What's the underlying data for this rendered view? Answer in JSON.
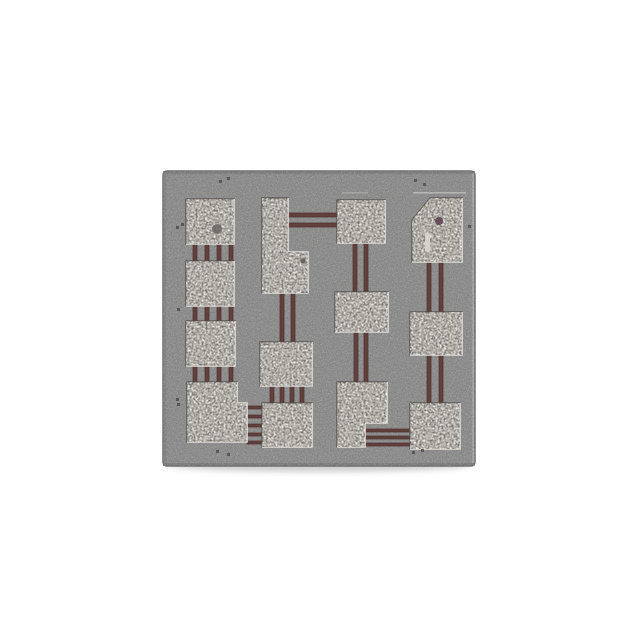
{
  "scene": {
    "type": "product-photo",
    "subject": "integrated-circuit chip macro photograph",
    "background_color": "#ffffff",
    "visible_text": ""
  },
  "chip": {
    "frame": {
      "x": 163,
      "y": 171,
      "width": 312,
      "height": 295,
      "corner_radius": 4
    },
    "colors": {
      "body": "#8b8b8b",
      "body_edge": "#6f6f6f",
      "pad_base": "#b7b4b0",
      "pad_edge_dark": "#504c48",
      "pad_edge_light": "#f5f3ee",
      "trace_fill": "#64403c",
      "trace_outline": "#47302e",
      "shadow": "#c2c2c2",
      "fiducial": "#4f4f4f"
    },
    "pad_count": 13,
    "pads": [
      {
        "name": "pad-col1-top",
        "shape": "rect",
        "x": 186,
        "y": 199,
        "w": 48,
        "h": 45
      },
      {
        "name": "pad-col1-second",
        "shape": "rect",
        "x": 186,
        "y": 261,
        "w": 48,
        "h": 45
      },
      {
        "name": "pad-col1-third",
        "shape": "rect",
        "x": 186,
        "y": 321,
        "w": 49,
        "h": 45
      },
      {
        "name": "pad-col1-bottom-L",
        "shape": "polygon",
        "points": [
          [
            187,
            382
          ],
          [
            237,
            382
          ],
          [
            237,
            403
          ],
          [
            247,
            403
          ],
          [
            247,
            442
          ],
          [
            187,
            442
          ]
        ],
        "shine": [
          [
            237,
            382
          ],
          [
            237,
            403
          ],
          [
            247,
            403
          ],
          [
            247,
            442
          ],
          [
            187,
            442
          ]
        ]
      },
      {
        "name": "pad-col2-top-L",
        "shape": "polygon",
        "points": [
          [
            262,
            198
          ],
          [
            288,
            198
          ],
          [
            288,
            252
          ],
          [
            308,
            252
          ],
          [
            308,
            293
          ],
          [
            262,
            293
          ]
        ],
        "shine": [
          [
            288,
            198
          ],
          [
            288,
            252
          ],
          [
            308,
            252
          ],
          [
            308,
            293
          ],
          [
            262,
            293
          ]
        ]
      },
      {
        "name": "pad-col2-middle",
        "shape": "rect",
        "x": 260,
        "y": 342,
        "w": 52,
        "h": 44
      },
      {
        "name": "pad-col2-bottom",
        "shape": "rect",
        "x": 262,
        "y": 403,
        "w": 50,
        "h": 44
      },
      {
        "name": "pad-col3-top",
        "shape": "rect",
        "x": 337,
        "y": 200,
        "w": 48,
        "h": 43
      },
      {
        "name": "pad-col3-middle",
        "shape": "rect",
        "x": 335,
        "y": 292,
        "w": 53,
        "h": 40
      },
      {
        "name": "pad-col3-bottom-L",
        "shape": "polygon",
        "points": [
          [
            337,
            382
          ],
          [
            387,
            382
          ],
          [
            387,
            423
          ],
          [
            365,
            423
          ],
          [
            365,
            447
          ],
          [
            337,
            447
          ]
        ],
        "shine": [
          [
            387,
            382
          ],
          [
            387,
            423
          ],
          [
            365,
            423
          ],
          [
            365,
            447
          ],
          [
            337,
            447
          ]
        ]
      },
      {
        "name": "pad-col4-top-pentagon",
        "shape": "polygon",
        "points": [
          [
            430,
            198
          ],
          [
            462,
            198
          ],
          [
            462,
            262
          ],
          [
            412,
            262
          ],
          [
            412,
            220
          ]
        ],
        "shine": [
          [
            462,
            198
          ],
          [
            462,
            262
          ],
          [
            412,
            262
          ]
        ]
      },
      {
        "name": "pad-col4-middle",
        "shape": "rect",
        "x": 410,
        "y": 312,
        "w": 52,
        "h": 43
      },
      {
        "name": "pad-col4-bottom",
        "shape": "rect",
        "x": 410,
        "y": 403,
        "w": 50,
        "h": 46
      }
    ],
    "traces": [
      {
        "x": 193,
        "y": 244,
        "w": 4,
        "h": 18
      },
      {
        "x": 205,
        "y": 244,
        "w": 4,
        "h": 18
      },
      {
        "x": 217,
        "y": 244,
        "w": 4,
        "h": 18
      },
      {
        "x": 229,
        "y": 244,
        "w": 4,
        "h": 18
      },
      {
        "x": 193,
        "y": 306,
        "w": 4,
        "h": 16
      },
      {
        "x": 205,
        "y": 306,
        "w": 4,
        "h": 16
      },
      {
        "x": 217,
        "y": 306,
        "w": 4,
        "h": 16
      },
      {
        "x": 229,
        "y": 306,
        "w": 4,
        "h": 16
      },
      {
        "x": 193,
        "y": 366,
        "w": 4,
        "h": 17
      },
      {
        "x": 205,
        "y": 366,
        "w": 4,
        "h": 17
      },
      {
        "x": 217,
        "y": 366,
        "w": 4,
        "h": 17
      },
      {
        "x": 229,
        "y": 366,
        "w": 4,
        "h": 17
      },
      {
        "x": 247,
        "y": 406,
        "w": 15,
        "h": 3
      },
      {
        "x": 247,
        "y": 415,
        "w": 15,
        "h": 3
      },
      {
        "x": 247,
        "y": 424,
        "w": 15,
        "h": 3
      },
      {
        "x": 247,
        "y": 433,
        "w": 15,
        "h": 3
      },
      {
        "x": 247,
        "y": 441,
        "w": 15,
        "h": 3
      },
      {
        "x": 288,
        "y": 213,
        "w": 49,
        "h": 4
      },
      {
        "x": 288,
        "y": 223,
        "w": 49,
        "h": 4
      },
      {
        "x": 280,
        "y": 293,
        "w": 4,
        "h": 49
      },
      {
        "x": 291,
        "y": 293,
        "w": 4,
        "h": 49
      },
      {
        "x": 270,
        "y": 386,
        "w": 4,
        "h": 17
      },
      {
        "x": 280,
        "y": 386,
        "w": 4,
        "h": 17
      },
      {
        "x": 290,
        "y": 386,
        "w": 4,
        "h": 17
      },
      {
        "x": 300,
        "y": 386,
        "w": 4,
        "h": 17
      },
      {
        "x": 353,
        "y": 243,
        "w": 4,
        "h": 49
      },
      {
        "x": 364,
        "y": 243,
        "w": 4,
        "h": 49
      },
      {
        "x": 354,
        "y": 332,
        "w": 4,
        "h": 50
      },
      {
        "x": 364,
        "y": 332,
        "w": 4,
        "h": 50
      },
      {
        "x": 365,
        "y": 429,
        "w": 47,
        "h": 3
      },
      {
        "x": 365,
        "y": 436,
        "w": 47,
        "h": 3
      },
      {
        "x": 365,
        "y": 443,
        "w": 45,
        "h": 3
      },
      {
        "x": 427,
        "y": 262,
        "w": 4,
        "h": 50
      },
      {
        "x": 439,
        "y": 262,
        "w": 4,
        "h": 50
      },
      {
        "x": 427,
        "y": 355,
        "w": 4,
        "h": 48
      },
      {
        "x": 439,
        "y": 355,
        "w": 4,
        "h": 48
      }
    ],
    "spots": [
      {
        "kind": "circle",
        "cx": 217,
        "cy": 229,
        "r": 5,
        "color": "#6e6a66"
      },
      {
        "kind": "circle",
        "cx": 439,
        "cy": 221,
        "r": 4,
        "color": "#5c4650"
      },
      {
        "kind": "rect",
        "x": 425,
        "y": 233,
        "w": 5,
        "h": 19,
        "color": "#d9d6d1"
      },
      {
        "kind": "circle",
        "cx": 303,
        "cy": 261,
        "r": 2.5,
        "color": "#5f5b57"
      }
    ],
    "etch_lines": [
      {
        "x": 413,
        "y": 192,
        "w": 53,
        "h": 1.5,
        "color": "#bdbdbd"
      },
      {
        "x": 342,
        "y": 192,
        "w": 26,
        "h": 1.5,
        "color": "#a9a9a9"
      }
    ],
    "fiducials": [
      {
        "x": 219,
        "y": 180
      },
      {
        "x": 227,
        "y": 177
      },
      {
        "x": 414,
        "y": 179
      },
      {
        "x": 423,
        "y": 183
      },
      {
        "x": 216,
        "y": 450
      },
      {
        "x": 227,
        "y": 453
      },
      {
        "x": 412,
        "y": 451
      },
      {
        "x": 421,
        "y": 449
      },
      {
        "x": 176,
        "y": 226
      },
      {
        "x": 181,
        "y": 223
      },
      {
        "x": 176,
        "y": 398
      },
      {
        "x": 177,
        "y": 403
      },
      {
        "x": 177,
        "y": 308
      },
      {
        "x": 468,
        "y": 225
      }
    ]
  }
}
